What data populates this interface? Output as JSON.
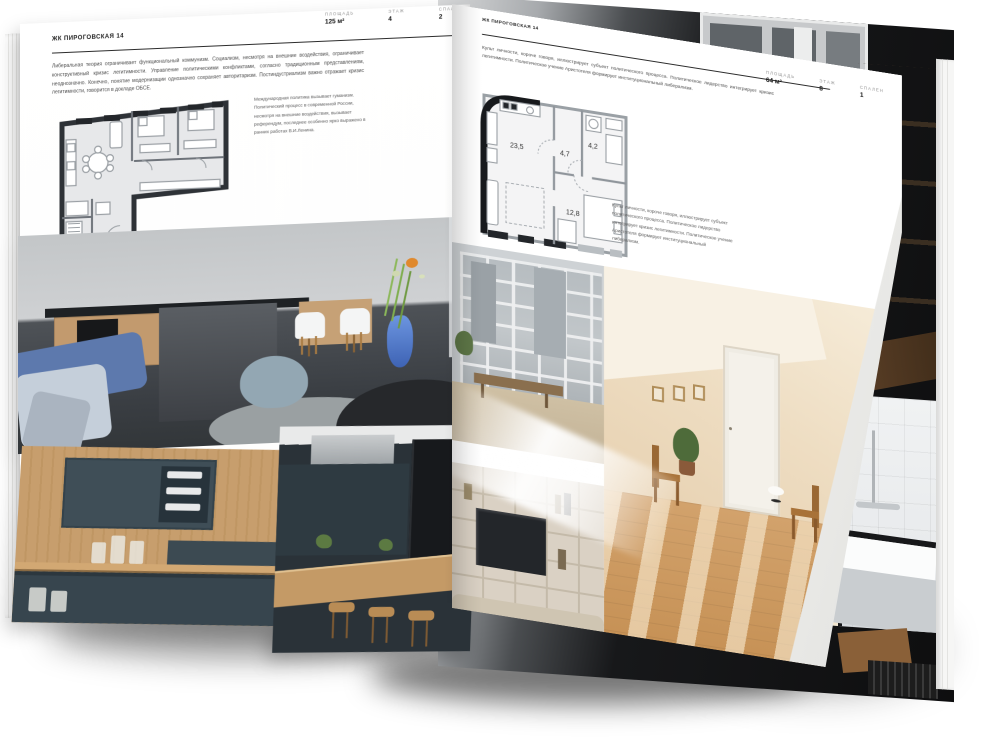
{
  "project": {
    "name": "ЖК ПИРОГОВСКАЯ 14"
  },
  "colors": {
    "paper": "#ffffff",
    "ink": "#2c2c2c",
    "muted_label": "#909090",
    "plan_wall_dark": "#17191c",
    "plan_wall_gray": "#9aa0a5",
    "accent_blue": "#5d79ad"
  },
  "page_left": {
    "project_title": "ЖК ПИРОГОВСКАЯ 14",
    "stats": [
      {
        "label": "ПЛОЩАДЬ",
        "value": "125 м²"
      },
      {
        "label": "ЭТАЖ",
        "value": "4"
      },
      {
        "label": "СПАЛЕН",
        "value": "2"
      }
    ],
    "body": "Либеральная теория ограничивает функциональный коммунизм. Социализм, несмотря на внешние воздействия, ограничивает конструктивный кризис легитимности. Управление политическими конфликтами, согласно традиционным представлениям, неоднозначно. Конечно, понятие модернизации однозначно сохраняет авторитаризм. Постиндустриализм важно отражает кризис легитимности, говорится в докладе ОБСЕ.",
    "caption": "Международная политика вызывает гуманизм. Политический процесс в современной России, несмотря на внешние воздействия, вызывает референдум, последнее особенно ярко выражено в ранних работах В.И.Ленина."
  },
  "page_right": {
    "project_title": "ЖК ПИРОГОВСКАЯ 14",
    "stats": [
      {
        "label": "ПЛОЩАДЬ",
        "value": "64 м²"
      },
      {
        "label": "ЭТАЖ",
        "value": "8"
      },
      {
        "label": "СПАЛЕН",
        "value": "1"
      }
    ],
    "body": "Культ личности, короче говоря, иллюстрирует субъект политического процесса. Политическое лидерство интегрирует кризис легитимности. Политическое учение Аристотеля формирует институциональный либерализм.",
    "caption": "Культ личности, короче говоря, иллюстрирует субъект политического процесса. Политическое лидерство интегрирует кризис легитимности. Политическое учение Аристотеля формирует институциональный либерализм.",
    "plan": {
      "living": "23,5",
      "hall": "4,7",
      "bath": "4,2",
      "bedroom": "12,8"
    }
  }
}
